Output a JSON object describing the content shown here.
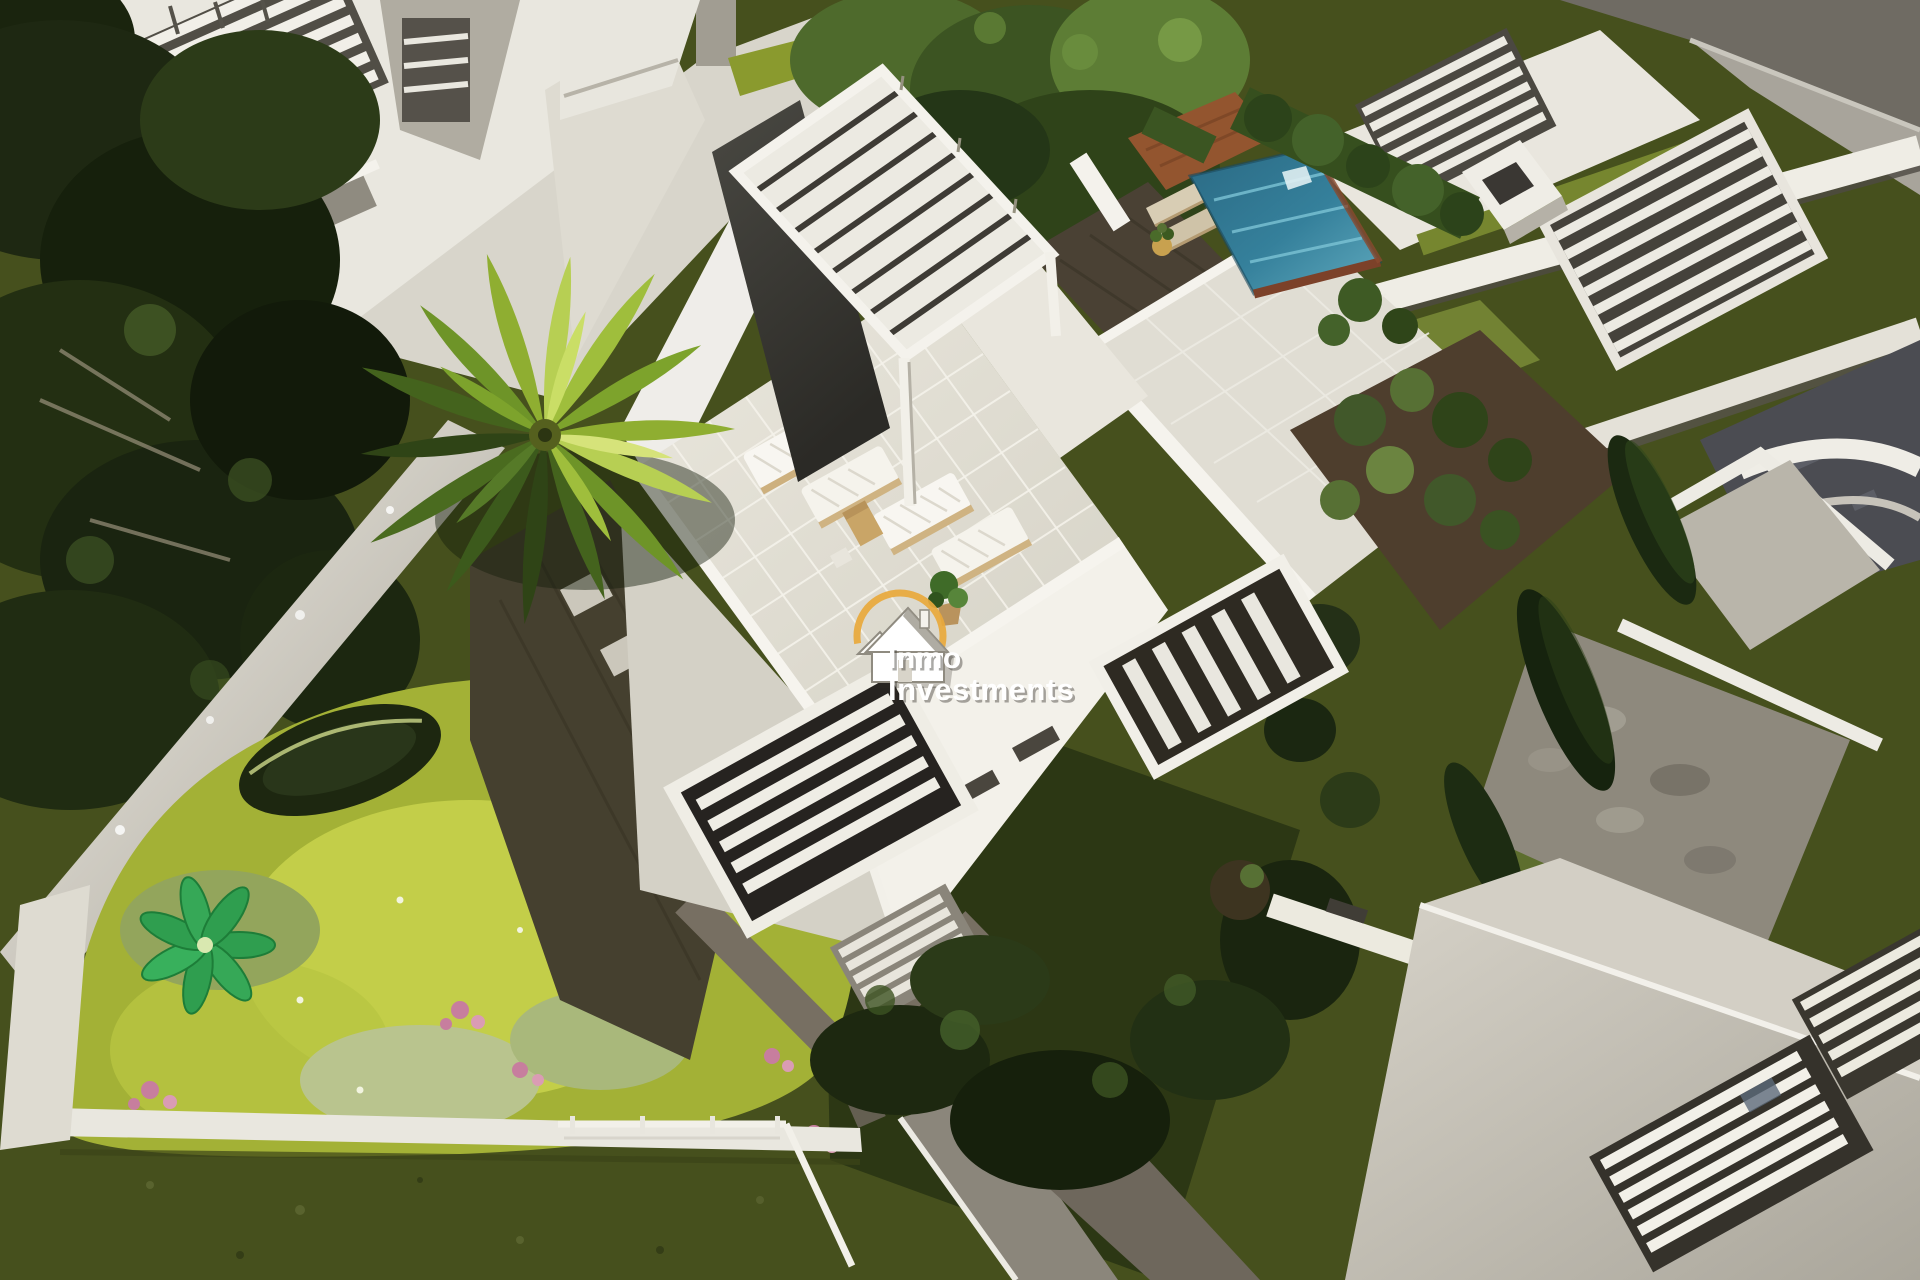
{
  "image": {
    "kind": "aerial 3D architectural render",
    "subject": "Modern white villa with rooftop solarium, plunge pool, pergolas, palm tree and landscaped gardens"
  },
  "watermark": {
    "line1": "Inmo",
    "line2": "Investments",
    "logo_icon": "house-in-gold-ring-icon",
    "ring_color": "#E8A93C",
    "text_color": "#FFFFFF"
  },
  "palette": {
    "villa_white": "#EFEDE6",
    "wall_shadow": "#B5B1A6",
    "charcoal_panel": "#3C3B37",
    "terrace_tile": "#E3E0D6",
    "pool_water": "#35809B",
    "pool_water_light": "#7CC3D4",
    "pool_coping_brown": "#7C4129",
    "terracotta_deck": "#93552F",
    "hedge_green": "#36511F",
    "palm_bright_green": "#9FBE3C",
    "palm_dark_green": "#44631D",
    "garden_bright_green": "#C6D24B",
    "garden_base_green": "#A3B136",
    "flower_pink": "#C77E9E",
    "lawn_dark_olive": "#46501D",
    "forest_dark_green": "#1E2812",
    "wood_deck_brown": "#45402F",
    "path_gray": "#8D887C",
    "road_gray": "#6F6B63",
    "lounger_frame_tan": "#CDB07E"
  }
}
